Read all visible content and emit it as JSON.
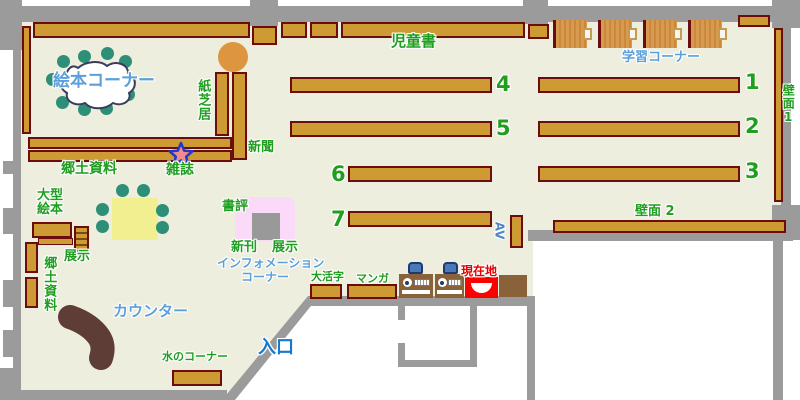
{
  "map_title": "図書館フロアマップ",
  "colors": {
    "floor": "#EDEEDD",
    "wall": "#9B9B9B",
    "shelf_fill": "#CE9A33",
    "shelf_border": "#6B0D0D",
    "study_desk_wood": "#D79A4E",
    "pc_desk_brown": "#8A6239",
    "chair_blue": "#4A79B8",
    "chair_dot_green": "#2D8F77",
    "table_yellow": "#F1EF8F",
    "round_table_orange": "#DD9540",
    "counter_brown": "#5E3D36",
    "display_pink": "#FBD9F9",
    "display_gray": "#999999",
    "current_location_red": "#FF0000",
    "label_green": "#1F9E1F",
    "label_blue": "#5C9FDA",
    "entrance_blue": "#1778D0",
    "current_location_text_red": "#E60000",
    "star_fill": "#F08C8C",
    "star_border": "#2238C8",
    "cloud_border": "#3B3B5E"
  },
  "labels": {
    "jidosho": "児童書",
    "gakushu_corner": "学習コーナー",
    "hekimen1": "壁面1",
    "hekimen2": "壁面 2",
    "ehon_corner": "絵本コーナー",
    "kamishibai": "紙芝居",
    "shinbun": "新聞",
    "kyodo_shiryo": "郷土資料",
    "zasshi": "雑誌",
    "ogata_ehon_line1": "大型",
    "ogata_ehon_line2": "絵本",
    "tenji_left": "展示",
    "kyodo_shiryo_side": "郷土資料",
    "shohyo": "書評",
    "shinkan": "新刊",
    "tenji_center": "展示",
    "information_line1": "インフォメーション",
    "information_line2": "コーナー",
    "okatsuji": "大活字",
    "manga": "マンガ",
    "genzaichi": "現在地",
    "counter": "カウンター",
    "mizu_corner": "水のコーナー",
    "iriguchi": "入口",
    "av": "AV",
    "shelf_numbers": {
      "n1": "1",
      "n2": "2",
      "n3": "3",
      "n4": "4",
      "n5": "5",
      "n6": "6",
      "n7": "7"
    }
  }
}
